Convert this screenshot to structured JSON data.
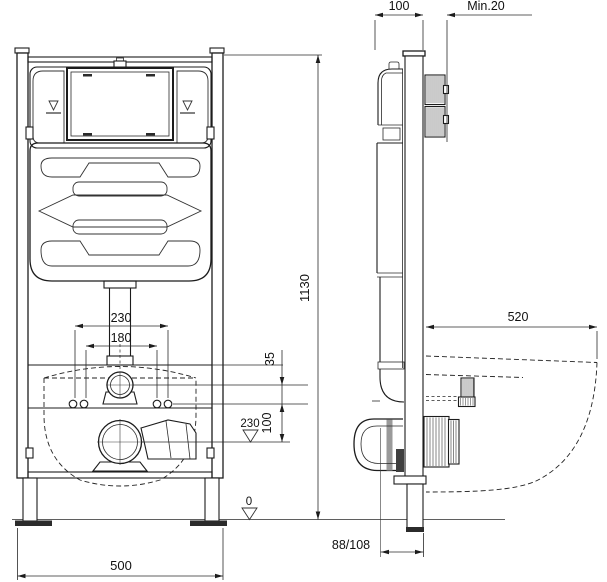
{
  "drawing_type": "wc-installation-frame-technical-drawing",
  "colors": {
    "line": "#1c1c1c",
    "dim_line": "#2a2a2a",
    "hatch": "#8c8c8c",
    "fill_dark": "#2b2b2b",
    "background": "#ffffff"
  },
  "front": {
    "dims": {
      "frame_height": "1130",
      "frame_width": "500",
      "fixing_spacing_outer": "230",
      "fixing_spacing_inner": "180",
      "inlet_offset": "35",
      "fixing_to_outlet": "100",
      "outlet_level": "230",
      "floor_level": "0"
    }
  },
  "side": {
    "dims": {
      "frame_depth": "100",
      "min_wall_thickness": "Min.20",
      "bowl_projection": "520",
      "outlet_distance": "88/108"
    }
  }
}
